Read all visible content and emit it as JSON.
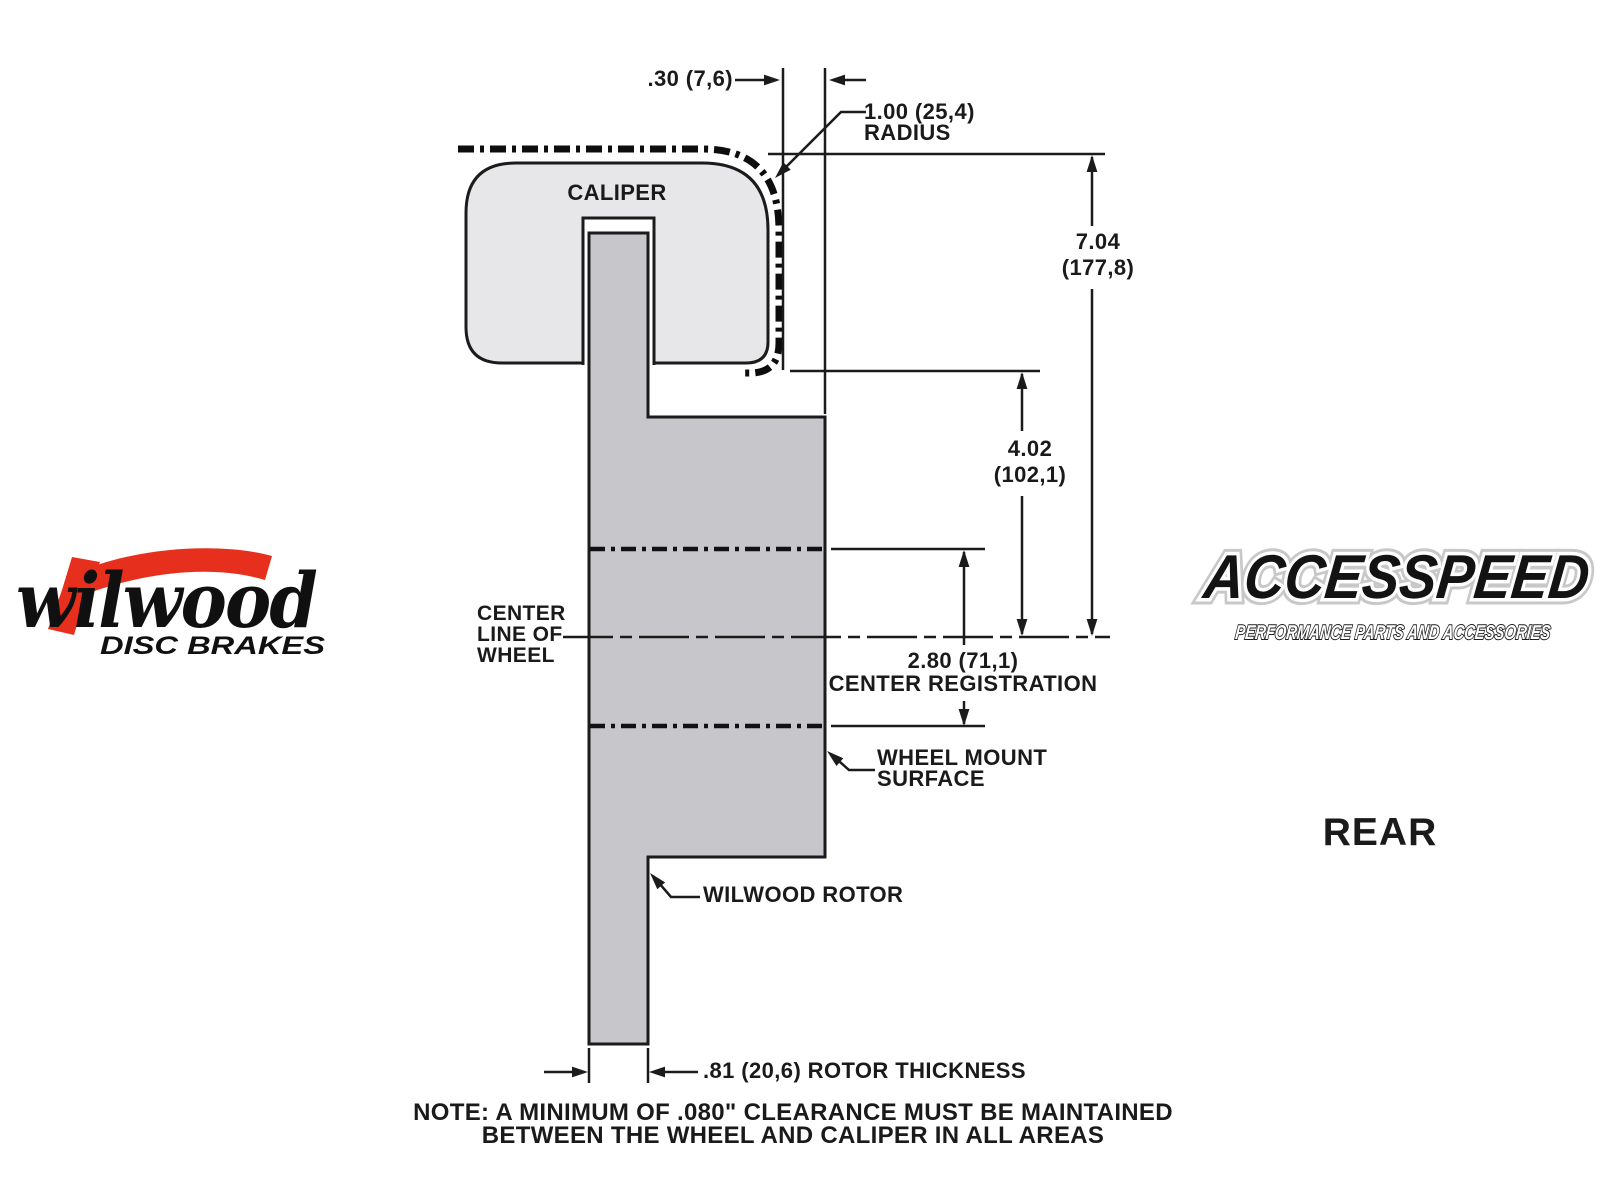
{
  "diagram": {
    "caliper_label": "CALIPER",
    "clearance_dim": ".30 (7,6)",
    "radius_dim": "1.00 (25,4)",
    "radius_word": "RADIUS",
    "overall_height_in": "7.04",
    "overall_height_mm": "(177,8)",
    "mount_height_in": "4.02",
    "mount_height_mm": "(102,1)",
    "centerline_line1": "CENTER",
    "centerline_line2": "LINE OF",
    "centerline_line3": "WHEEL",
    "registration_dim": "2.80 (71,1)",
    "registration_label": "CENTER REGISTRATION",
    "wheel_mount_line1": "WHEEL MOUNT",
    "wheel_mount_line2": "SURFACE",
    "rotor_callout": "WILWOOD ROTOR",
    "rotor_thickness_dim": ".81 (20,6) ROTOR THICKNESS",
    "note_line1": "NOTE: A MINIMUM OF .080\" CLEARANCE MUST BE MAINTAINED",
    "note_line2": "BETWEEN THE WHEEL AND CALIPER IN ALL AREAS",
    "view_label": "REAR"
  },
  "branding": {
    "wilwood_name": "wilwood",
    "wilwood_sub": "DISC BRAKES",
    "accesspeed_name": "ACCESSPEED",
    "accesspeed_sub": "PERFORMANCE PARTS AND ACCESSORIES"
  },
  "colors": {
    "caliper_fill": "#e7e7e9",
    "rotor_fill": "#c7c7cb",
    "line": "#1b1b1b",
    "brand_red": "#e6301d"
  }
}
